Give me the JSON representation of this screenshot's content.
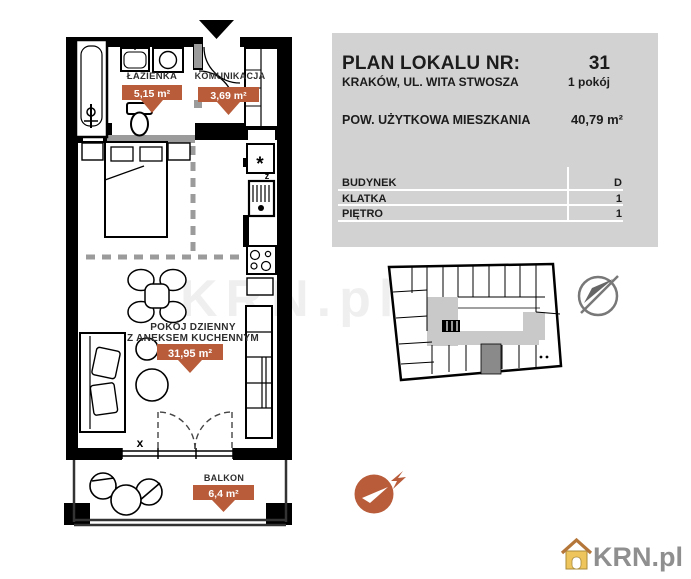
{
  "panel": {
    "title": "PLAN LOKALU NR:",
    "unit_number": "31",
    "address": "KRAKÓW, UL. WITA STWOSZA",
    "rooms": "1 pokój",
    "area_label": "POW. UŻYTKOWA MIESZKANIA",
    "area_value": "40,79 m²",
    "details": [
      {
        "label": "BUDYNEK",
        "value": "D"
      },
      {
        "label": "KLATKA",
        "value": "1"
      },
      {
        "label": "PIĘTRO",
        "value": "1"
      }
    ]
  },
  "floorplan": {
    "rooms": [
      {
        "name": "ŁAZIENKA",
        "area": "5,15 m²"
      },
      {
        "name": "KOMUNIKACJA",
        "area": "3,69 m²"
      },
      {
        "name_line1": "POKÓJ DZIENNY",
        "name_line2": "Z ANEKSEM KUCHENNYM",
        "area": "31,95 m²"
      },
      {
        "name": "BALKON",
        "area": "6,4 m²"
      }
    ],
    "annotations": {
      "window_marker": "x",
      "sink_marker": "z",
      "freezer_marker": "*"
    }
  },
  "branding": {
    "logo_text": "KRN.pl",
    "watermark": "KRN.pl"
  },
  "colors": {
    "accent_orange": "#b85c3a",
    "panel_gray": "#d2d2d2",
    "wall_black": "#000000",
    "corridor_gray": "#c9c9c9",
    "unit_highlight": "#8a8a8a",
    "logo_gray": "#8f8f8f",
    "logo_gold": "#eec45c"
  }
}
